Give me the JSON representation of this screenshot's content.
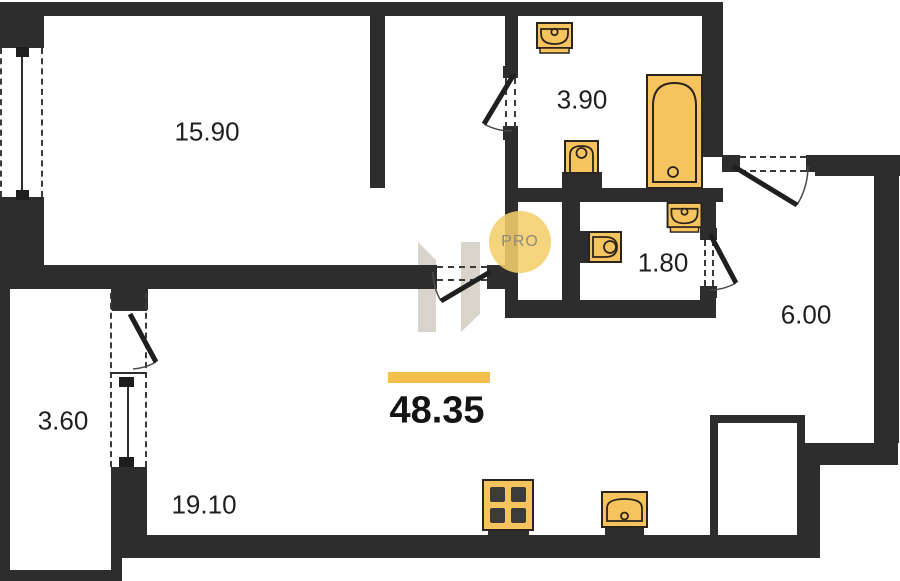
{
  "plan": {
    "total": {
      "area": "48.35"
    },
    "watermark": {
      "text": "PRO"
    },
    "rooms": {
      "bedroom": {
        "area": "15.90"
      },
      "bathroom": {
        "area": "3.90"
      },
      "wc": {
        "area": "1.80"
      },
      "hall": {
        "area": "6.00"
      },
      "balcony": {
        "area": "3.60"
      },
      "living": {
        "area": "19.10"
      }
    },
    "icons": {
      "bathroom_sink": "sink-icon",
      "bathroom_toilet": "toilet-icon",
      "bathtub": "bathtub-icon",
      "wc_sink": "sink-icon",
      "wc_toilet": "toilet-icon",
      "stove": "stove-icon",
      "kitchen_sink": "kitchen-sink-icon"
    },
    "colors": {
      "wall": "#2d2d2d",
      "fixture_fill": "#f6c45f",
      "fixture_outline": "#2b241c",
      "accent": "#f3c04f",
      "watermark_yellow": "#f2cf6b",
      "watermark_gray": "#d9d4cb",
      "text": "#1f1f1e"
    }
  }
}
